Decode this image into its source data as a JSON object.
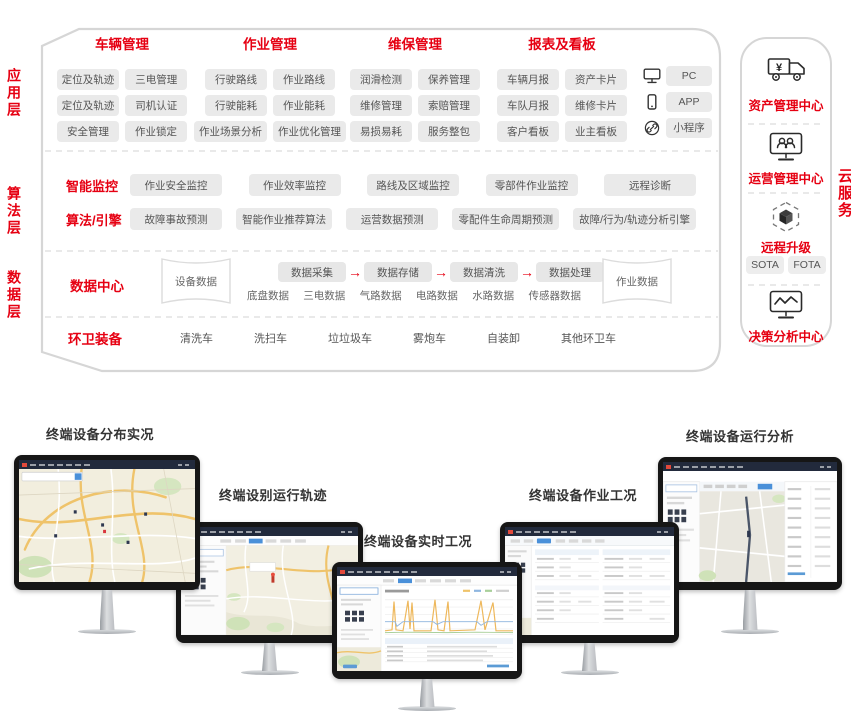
{
  "colors": {
    "accent": "#e60012",
    "chip_bg": "#eaeaea",
    "chip_text": "#555555"
  },
  "layers": [
    {
      "label": "应用层"
    },
    {
      "label": "算法层"
    },
    {
      "label": "数据层"
    }
  ],
  "app": {
    "groups": [
      {
        "title": "车辆管理",
        "rows": [
          [
            "定位及轨迹",
            "三电管理"
          ],
          [
            "定位及轨迹",
            "司机认证"
          ],
          [
            "安全管理",
            "作业锁定"
          ]
        ]
      },
      {
        "title": "作业管理",
        "rows": [
          [
            "行驶路线",
            "作业路线"
          ],
          [
            "行驶能耗",
            "作业能耗"
          ],
          [
            "作业场景分析",
            "作业优化管理"
          ]
        ]
      },
      {
        "title": "维保管理",
        "rows": [
          [
            "润滑检测",
            "保养管理"
          ],
          [
            "维修管理",
            "索赔管理"
          ],
          [
            "易损易耗",
            "服务整包"
          ]
        ]
      },
      {
        "title": "报表及看板",
        "rows": [
          [
            "车辆月报",
            "资产卡片"
          ],
          [
            "车队月报",
            "维修卡片"
          ],
          [
            "客户看板",
            "业主看板"
          ]
        ]
      }
    ],
    "platforms": [
      {
        "icon": "pc-icon",
        "label": "PC"
      },
      {
        "icon": "smartphone-icon",
        "label": "APP"
      },
      {
        "icon": "link-icon",
        "label": "小程序"
      }
    ]
  },
  "algo": {
    "rows": [
      {
        "title": "智能监控",
        "chips": [
          "作业安全监控",
          "作业效率监控",
          "路线及区域监控",
          "零部件作业监控",
          "远程诊断"
        ]
      },
      {
        "title": "算法/引擎",
        "chips": [
          "故障事故预测",
          "智能作业推荐算法",
          "运营数据预测",
          "零配件生命周期预测",
          "故障/行为/轨迹分析引擎"
        ]
      }
    ]
  },
  "data_center": {
    "title": "数据中心",
    "device_store": "设备数据",
    "job_store": "作业数据",
    "flow": [
      "数据采集",
      "数据存储",
      "数据清洗",
      "数据处理"
    ],
    "flow_arrow": "→",
    "sources": [
      "底盘数据",
      "三电数据",
      "气路数据",
      "电路数据",
      "水路数据",
      "传感器数据"
    ]
  },
  "equipment": {
    "title": "环卫装备",
    "items": [
      "清洗车",
      "洗扫车",
      "垃垃圾车",
      "雾炮车",
      "自装卸",
      "其他环卫车"
    ]
  },
  "cloud": {
    "vertical_label": "云服务",
    "sections": [
      {
        "icon": "truck-yen-icon",
        "label": "资产管理中心"
      },
      {
        "icon": "monitor-users-icon",
        "label": "运营管理中心"
      },
      {
        "icon": "ota-cube-icon",
        "label": "远程升级",
        "chips": [
          "SOTA",
          "FOTA"
        ]
      },
      {
        "icon": "monitor-chart-icon",
        "label": "决策分析中心"
      }
    ]
  },
  "monitors": [
    {
      "title": "终端设备分布实况"
    },
    {
      "title": "终端设别运行轨迹"
    },
    {
      "title": "终端设备实时工况"
    },
    {
      "title": "终端设备作业工况"
    },
    {
      "title": "终端设备运行分析"
    }
  ]
}
